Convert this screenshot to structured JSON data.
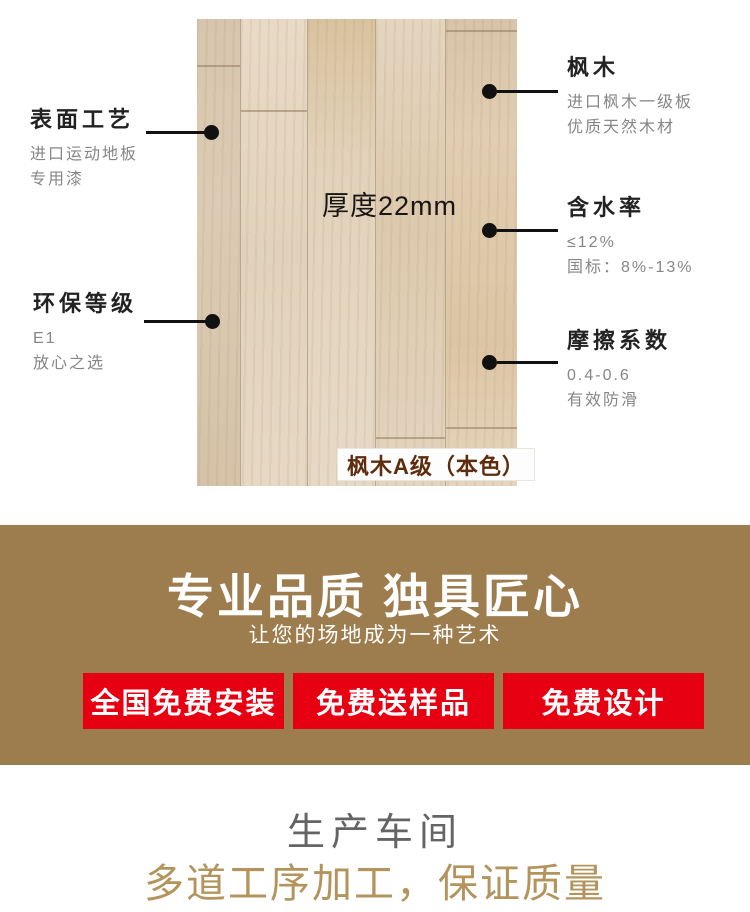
{
  "hero": {
    "thickness_label": "厚度22mm",
    "grade_label": "枫木A级（本色）",
    "annotations_left": [
      {
        "title": "表面工艺",
        "line1": "进口运动地板",
        "line2": "专用漆"
      },
      {
        "title": "环保等级",
        "line1": "E1",
        "line2": "放心之选"
      }
    ],
    "annotations_right": [
      {
        "title": "枫木",
        "line1": "进口枫木一级板",
        "line2": "优质天然木材"
      },
      {
        "title": "含水率",
        "line1": "≤12%",
        "line2": "国标：8%-13%"
      },
      {
        "title": "摩擦系数",
        "line1": "0.4-0.6",
        "line2": "有效防滑"
      }
    ]
  },
  "banner": {
    "title": "专业品质 独具匠心",
    "subtitle": "让您的场地成为一种艺术",
    "background_color": "#9d7c4e",
    "button_color": "#e60012",
    "buttons": [
      {
        "label": "全国免费安装"
      },
      {
        "label": "免费送样品"
      },
      {
        "label": "免费设计"
      }
    ]
  },
  "footer": {
    "title": "生产车间",
    "title_color": "#646464",
    "subtitle": "多道工序加工，保证质量",
    "subtitle_color": "#b3945c"
  }
}
